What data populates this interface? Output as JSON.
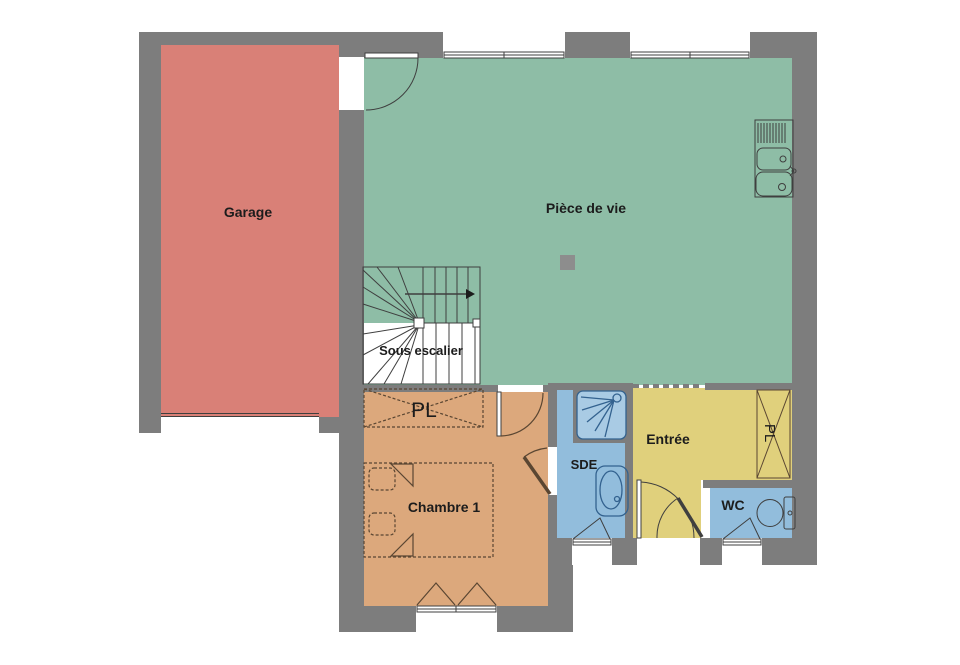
{
  "title": "Plan de maison - rez-de-chaussée",
  "colors": {
    "wall": "#7d7d7d",
    "shower_tray": "#a9cbe4",
    "fixture_blue": "#33628f",
    "door_dark": "#3f3f3f",
    "furniture_brown": "#5a4632",
    "garage_door": "#6e3a35",
    "post": "#8d8d8d"
  },
  "plan": {
    "rooms": [
      {
        "id": "garage",
        "label": "Garage",
        "color": "#d98077"
      },
      {
        "id": "living",
        "label": "Pièce de vie",
        "color": "#8ebda6"
      },
      {
        "id": "under-stairs",
        "label": "Sous escalier",
        "color": "#ffffff"
      },
      {
        "id": "closet-bedroom",
        "label": "PL",
        "color": "#dca87c"
      },
      {
        "id": "bedroom",
        "label": "Chambre 1",
        "color": "#dca87c"
      },
      {
        "id": "shower-room",
        "label": "SDE",
        "color": "#92bddc"
      },
      {
        "id": "entrance",
        "label": "Entrée",
        "color": "#e0d07c"
      },
      {
        "id": "closet-entrance",
        "label": "PL",
        "color": "#e0d07c"
      },
      {
        "id": "wc",
        "label": "WC",
        "color": "#92bddc"
      }
    ]
  }
}
